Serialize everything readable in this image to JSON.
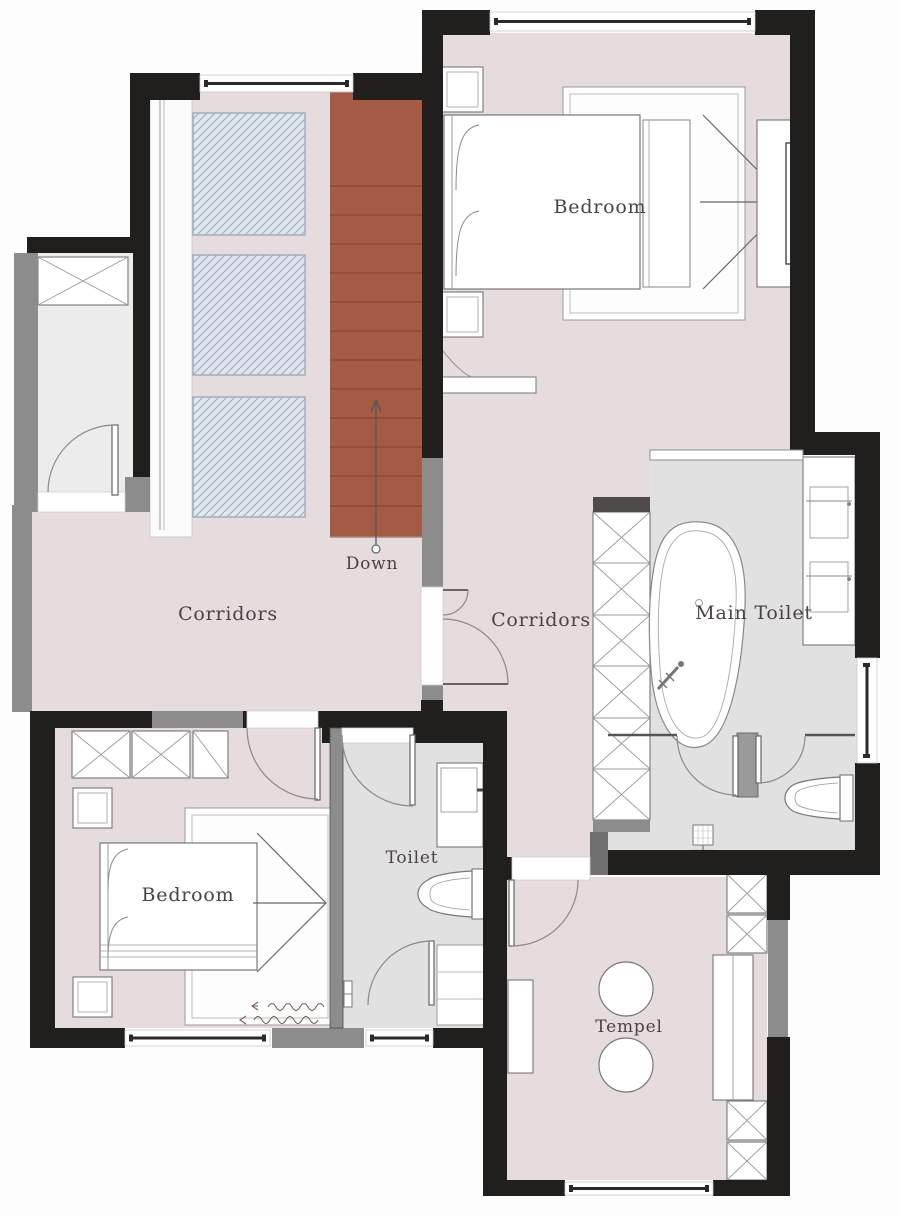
{
  "document": {
    "kind": "architectural floor plan",
    "view": "upper floor plan"
  },
  "labels": {
    "bedroom_top": "Bedroom",
    "bedroom_bottom": "Bedroom",
    "corridors_left": "Corridors",
    "corridors_center": "Corridors",
    "main_toilet": "Main Toilet",
    "toilet": "Toilet",
    "tempel": "Tempel",
    "down": "Down"
  },
  "colors": {
    "wall": "#211e1e",
    "wall_gray": "#8c8c8c",
    "floor_pink": "#e6dcde",
    "floor_gray": "#e2e1e1",
    "floor_light": "#edecec",
    "stairs_red": "#a45a44",
    "glass_panel": "#dfe7ed",
    "label_text": "#4a4245"
  }
}
